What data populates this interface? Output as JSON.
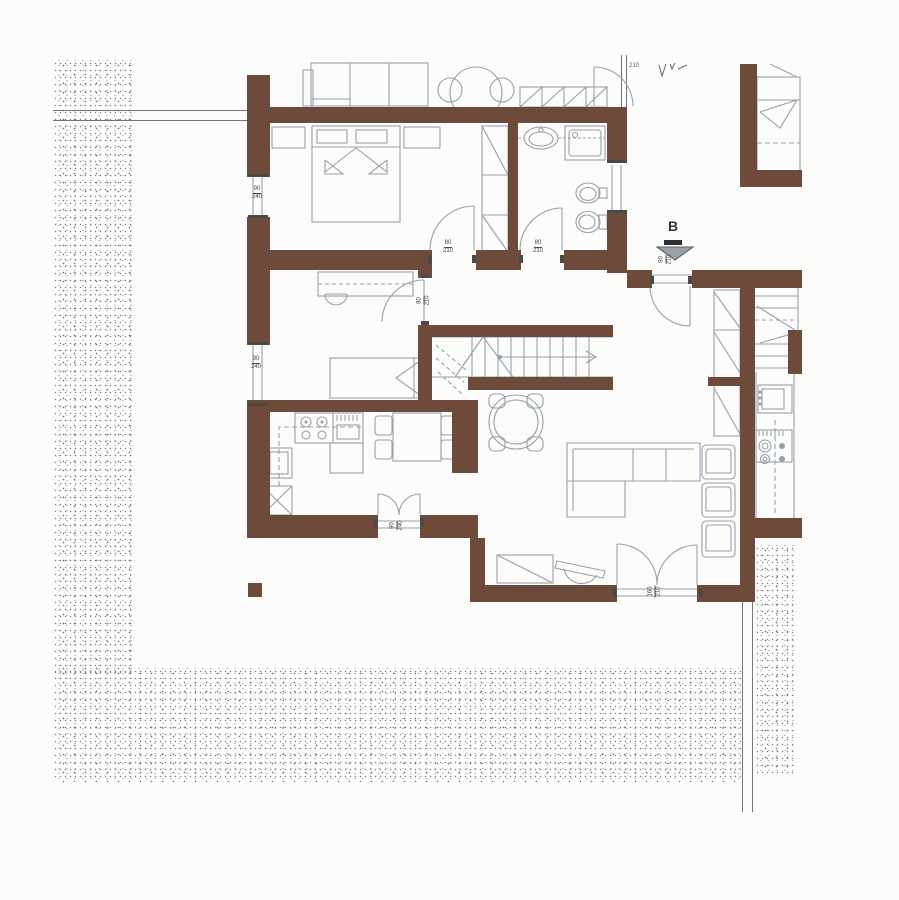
{
  "annotations": {
    "section_label": "B",
    "partial_top_label": "210"
  },
  "door_labels": {
    "bedroom_door": {
      "w": "80",
      "h": "210"
    },
    "bathroom_door": {
      "w": "80",
      "h": "210"
    },
    "study_door": {
      "w": "80",
      "h": "210"
    },
    "hall_door": {
      "w": "90",
      "h": "210"
    },
    "entry_door": {
      "w": "160",
      "h": "210"
    },
    "kitchen_french_door": {
      "w": "90",
      "h": "240"
    }
  },
  "window_labels": {
    "bedroom_window": {
      "w": "90",
      "h": "240"
    },
    "study_window": {
      "w": "90",
      "h": "240"
    }
  },
  "colors": {
    "wall": "#6d4a3a",
    "furniture_line": "#97a0ab",
    "label_text": "#3c4148",
    "stipple_dot": "#808080",
    "boundary_line": "#70757c"
  }
}
